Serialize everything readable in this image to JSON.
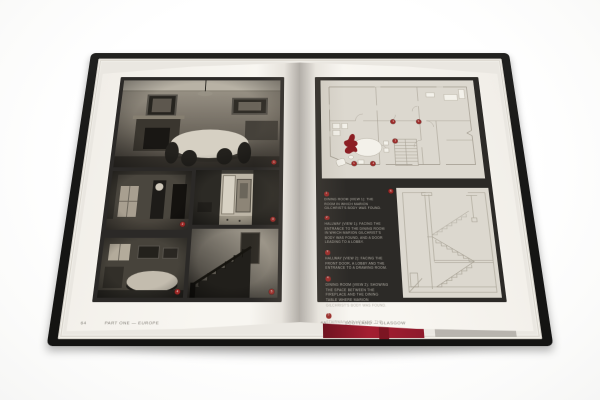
{
  "book": {
    "left_page": {
      "page_number": "64",
      "running_footer": "PART ONE — EUROPE",
      "photo_markers": [
        "1",
        "2",
        "3",
        "4",
        "5"
      ]
    },
    "right_page": {
      "page_number": "65",
      "running_footer": "SCOTLAND — GLASGOW",
      "plan_markers": [
        "1",
        "2",
        "3",
        "4",
        "5"
      ],
      "section_marker": "6",
      "captions": [
        {
          "number": "1",
          "text": "DINING ROOM (VIEW 1): THE ROOM IN WHICH MARION GILCHRIST'S BODY WAS FOUND."
        },
        {
          "number": "2",
          "text": "HALLWAY (VIEW 1): FACING THE ENTRANCE TO THE DINING ROOM IN WHICH MARION GILCHRIST'S BODY WAS FOUND, AND A DOOR LEADING TO A LOBBY."
        },
        {
          "number": "3",
          "text": "HALLWAY (VIEW 2): FACING THE FRONT DOOR, A LOBBY AND THE ENTRANCE TO A DRAWING ROOM."
        },
        {
          "number": "4",
          "text": "DINING ROOM (VIEW 2): SHOWING THE SPACE BETWEEN THE FIREPLACE AND THE DINING TABLE WHERE MARION GILCHRIST'S BODY WAS FOUND."
        },
        {
          "number": "5",
          "text": "STAIRWAY AND LANDING: THE STAIRS DOWN WHICH THE MURDERER FLED."
        }
      ]
    },
    "colors": {
      "accent_red": "#9e2a28",
      "blood_red": "#8c1f24",
      "plate_charcoal": "#2b2927",
      "plan_paper": "#dcd8cf",
      "page_paper": "#f6f4ef",
      "cover_black": "#191918"
    }
  }
}
